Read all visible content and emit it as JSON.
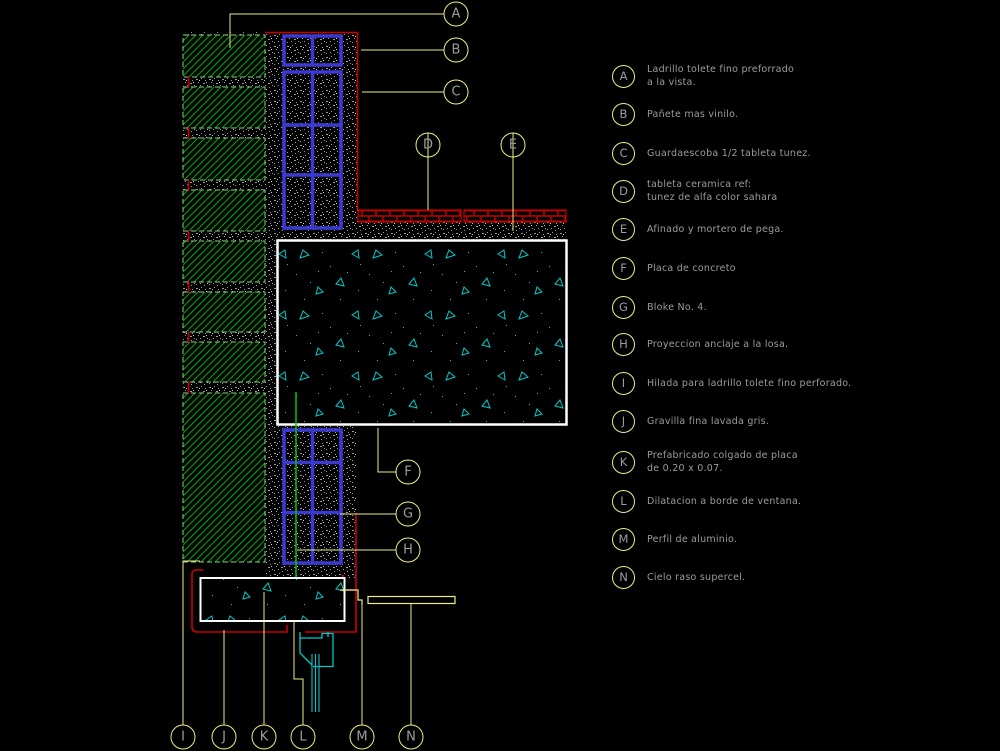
{
  "legend": {
    "items": [
      {
        "letter": "A",
        "line1": "Ladrillo tolete fino preforrado",
        "line2": "a la vista."
      },
      {
        "letter": "B",
        "line1": "Pañete mas vinilo."
      },
      {
        "letter": "C",
        "line1": "Guardaescoba 1/2 tableta tunez."
      },
      {
        "letter": "D",
        "line1": "tableta ceramica ref:",
        "line2": "tunez de alfa color sahara"
      },
      {
        "letter": "E",
        "line1": "Afinado y mortero de pega."
      },
      {
        "letter": "F",
        "line1": "Placa de concreto"
      },
      {
        "letter": "G",
        "line1": "Bloke No. 4."
      },
      {
        "letter": "H",
        "line1": "Proyeccion anclaje a la losa."
      },
      {
        "letter": "I",
        "line1": "Hilada para ladrillo tolete fino perforado."
      },
      {
        "letter": "J",
        "line1": "Gravilla fina lavada gris."
      },
      {
        "letter": "K",
        "line1": "Prefabricado colgado de placa",
        "line2": "de 0.20 x 0.07."
      },
      {
        "letter": "L",
        "line1": "Dilatacion a borde de ventana."
      },
      {
        "letter": "M",
        "line1": "Perfil de aluminio."
      },
      {
        "letter": "N",
        "line1": "Cielo raso supercel."
      }
    ]
  },
  "colors": {
    "background": "#000000",
    "leader_yellow": "#EDED86",
    "label_gray": "#9C9C9C",
    "brick_hatch_green": "#00A800",
    "brick_border_green": "#8CCF8C",
    "block_blue": "#3A3AD0",
    "wall_face_red": "#C80000",
    "concrete_hatch_cyan": "#00C8C8",
    "anchor_green": "#00C800",
    "slab_outline_white": "#FFFFFF",
    "mortar_stipple_gray": "#9A9A9A"
  }
}
